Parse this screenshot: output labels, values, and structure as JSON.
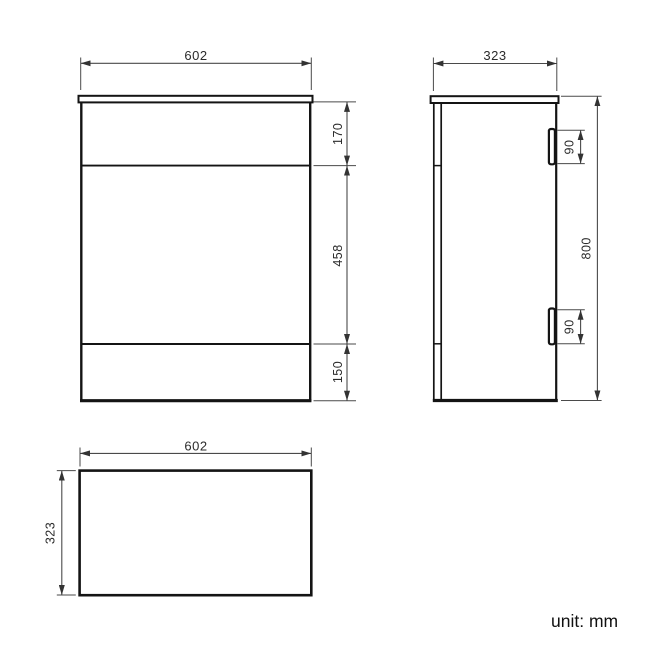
{
  "meta": {
    "unit_label": "unit: mm"
  },
  "front_view": {
    "width_label": "602",
    "section_labels": [
      "170",
      "458",
      "150"
    ]
  },
  "side_view": {
    "depth_label": "323",
    "height_label": "800",
    "hinge_labels": [
      "90",
      "90"
    ]
  },
  "plan_view": {
    "width_label": "602",
    "depth_label": "323"
  },
  "colors": {
    "background": "#ffffff",
    "body_line": "#141414",
    "dim_line": "#4a4a4a",
    "text": "#2b2b2b"
  }
}
